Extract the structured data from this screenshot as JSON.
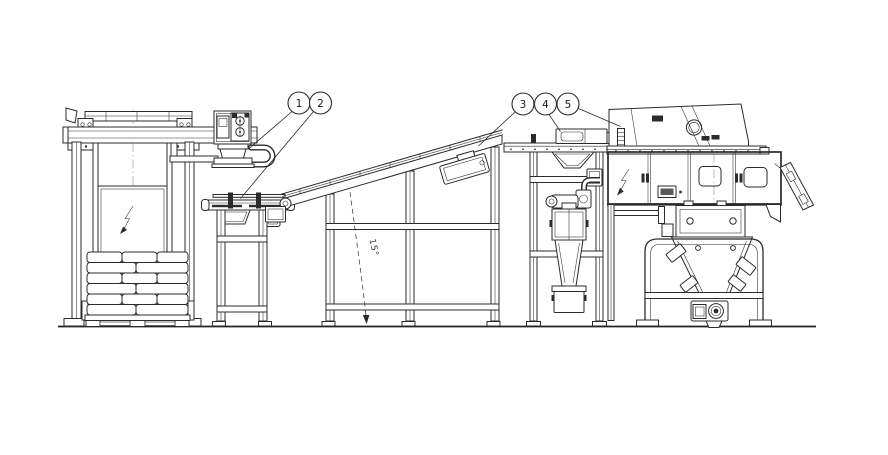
{
  "drawing": {
    "background_color": "#ffffff",
    "line_color": "#2b2b2b",
    "callouts": [
      {
        "label": "1",
        "points_to": "vacuum-lifter"
      },
      {
        "label": "2",
        "points_to": "infeed-table"
      },
      {
        "label": "3",
        "points_to": "inclined-conveyor-head"
      },
      {
        "label": "4",
        "points_to": "transfer-conveyor-device"
      },
      {
        "label": "5",
        "points_to": "bag-opening-machine"
      }
    ],
    "angle_dimension": {
      "label": "15°"
    }
  }
}
